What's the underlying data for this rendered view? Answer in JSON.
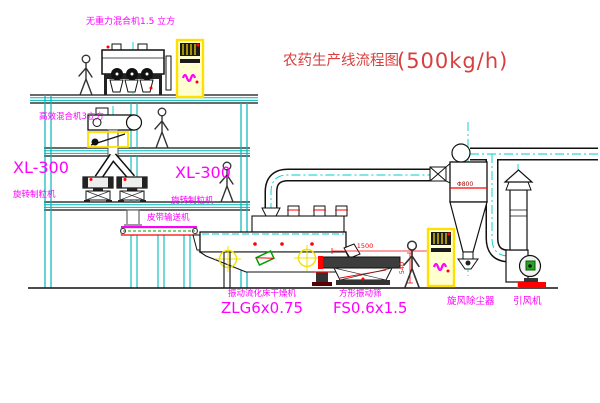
{
  "title": {
    "text": "农药生产线流程图",
    "capacity": "(500kg/h)"
  },
  "equipment": {
    "gravity_mixer": {
      "label": "无重力混合机1.5 立方"
    },
    "high_eff_mixer": {
      "label": "高效混合机3立方"
    },
    "granulator_left": {
      "model": "XL-300",
      "name": "旋转制粒机"
    },
    "granulator_right": {
      "model": "XL-300",
      "name": "旋转制粒机"
    },
    "belt_conveyor": {
      "label": "皮带输送机"
    },
    "dryer": {
      "name": "振动流化床干燥机",
      "model": "ZLG6x0.75"
    },
    "sieve": {
      "name": "方形振动筛",
      "model": "FS0.6x1.5",
      "dim_length": "1500",
      "dim_height": "540"
    },
    "cyclone": {
      "label": "旋风除尘器",
      "dim": "Φ800"
    },
    "fan": {
      "label": "引风机"
    }
  },
  "colors": {
    "structure_cyan": "#00b8b8",
    "centerline_cyan": "#00cccc",
    "label_magenta": "#ff00ff",
    "title_red": "#d84040",
    "dim_red": "#ff0000",
    "equipment_yellow": "#ffe000",
    "accent_green": "#00a000"
  }
}
